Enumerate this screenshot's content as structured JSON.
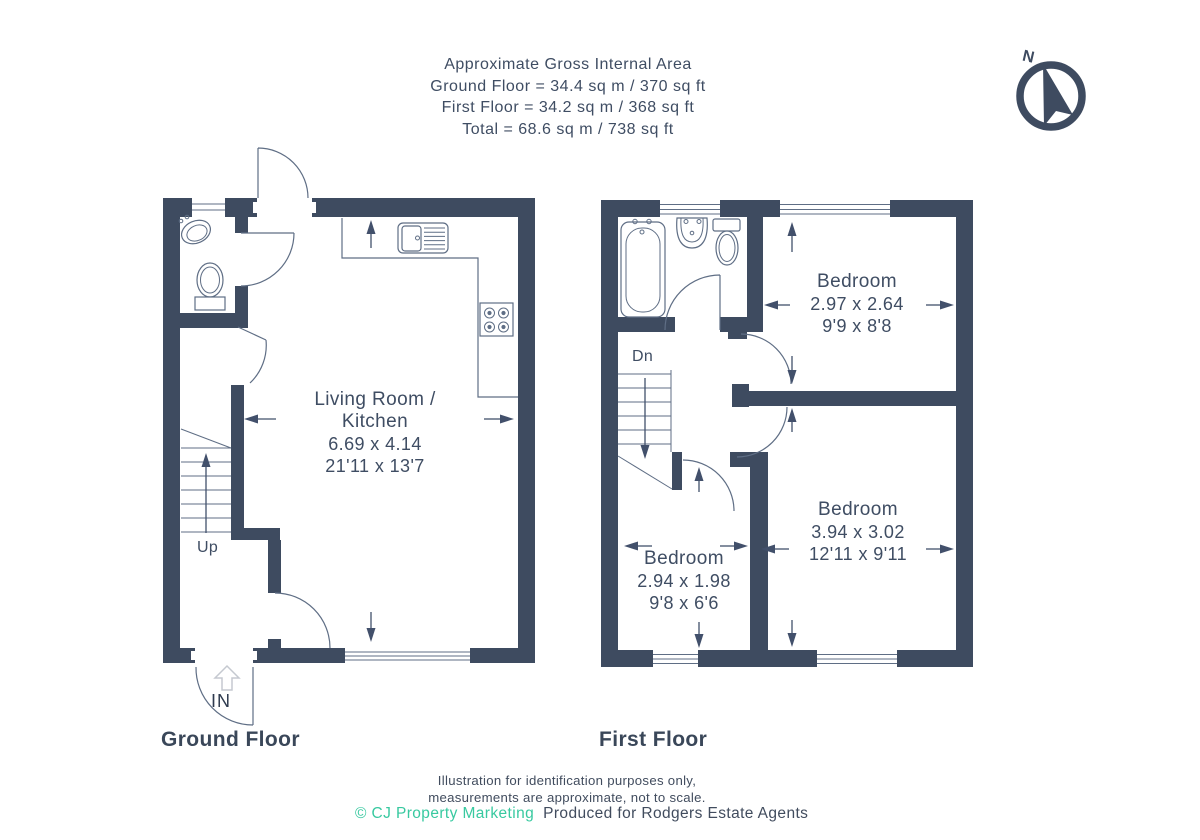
{
  "header": {
    "line1": "Approximate Gross Internal Area",
    "line2": "Ground Floor = 34.4 sq m / 370 sq ft",
    "line3": "First Floor = 34.2 sq m / 368 sq ft",
    "line4": "Total = 68.6 sq m / 738 sq ft"
  },
  "compass": {
    "label": "N"
  },
  "ground_floor": {
    "title": "Ground Floor",
    "living_room": {
      "name_line1": "Living Room /",
      "name_line2": "Kitchen",
      "dims_metric": "6.69 x 4.14",
      "dims_imperial": "21'11 x 13'7"
    },
    "stairs_label": "Up",
    "entrance_label": "IN"
  },
  "first_floor": {
    "title": "First Floor",
    "stairs_label": "Dn",
    "bedroom_front": {
      "name": "Bedroom",
      "dims_metric": "2.97 x 2.64",
      "dims_imperial": "9'9 x 8'8"
    },
    "bedroom_rear": {
      "name": "Bedroom",
      "dims_metric": "3.94 x 3.02",
      "dims_imperial": "12'11 x 9'11"
    },
    "bedroom_small": {
      "name": "Bedroom",
      "dims_metric": "2.94 x 1.98",
      "dims_imperial": "9'8 x 6'6"
    }
  },
  "footer": {
    "line1": "Illustration for identification purposes only,",
    "line2": "measurements are approximate, not to scale.",
    "credit_teal": "© CJ Property Marketing",
    "credit_dark": "Produced for Rodgers Estate Agents"
  },
  "colors": {
    "wall": "#3e4b60",
    "text": "#3f4d63",
    "fixture_line": "#5f6e85",
    "teal": "#38c9a0"
  }
}
